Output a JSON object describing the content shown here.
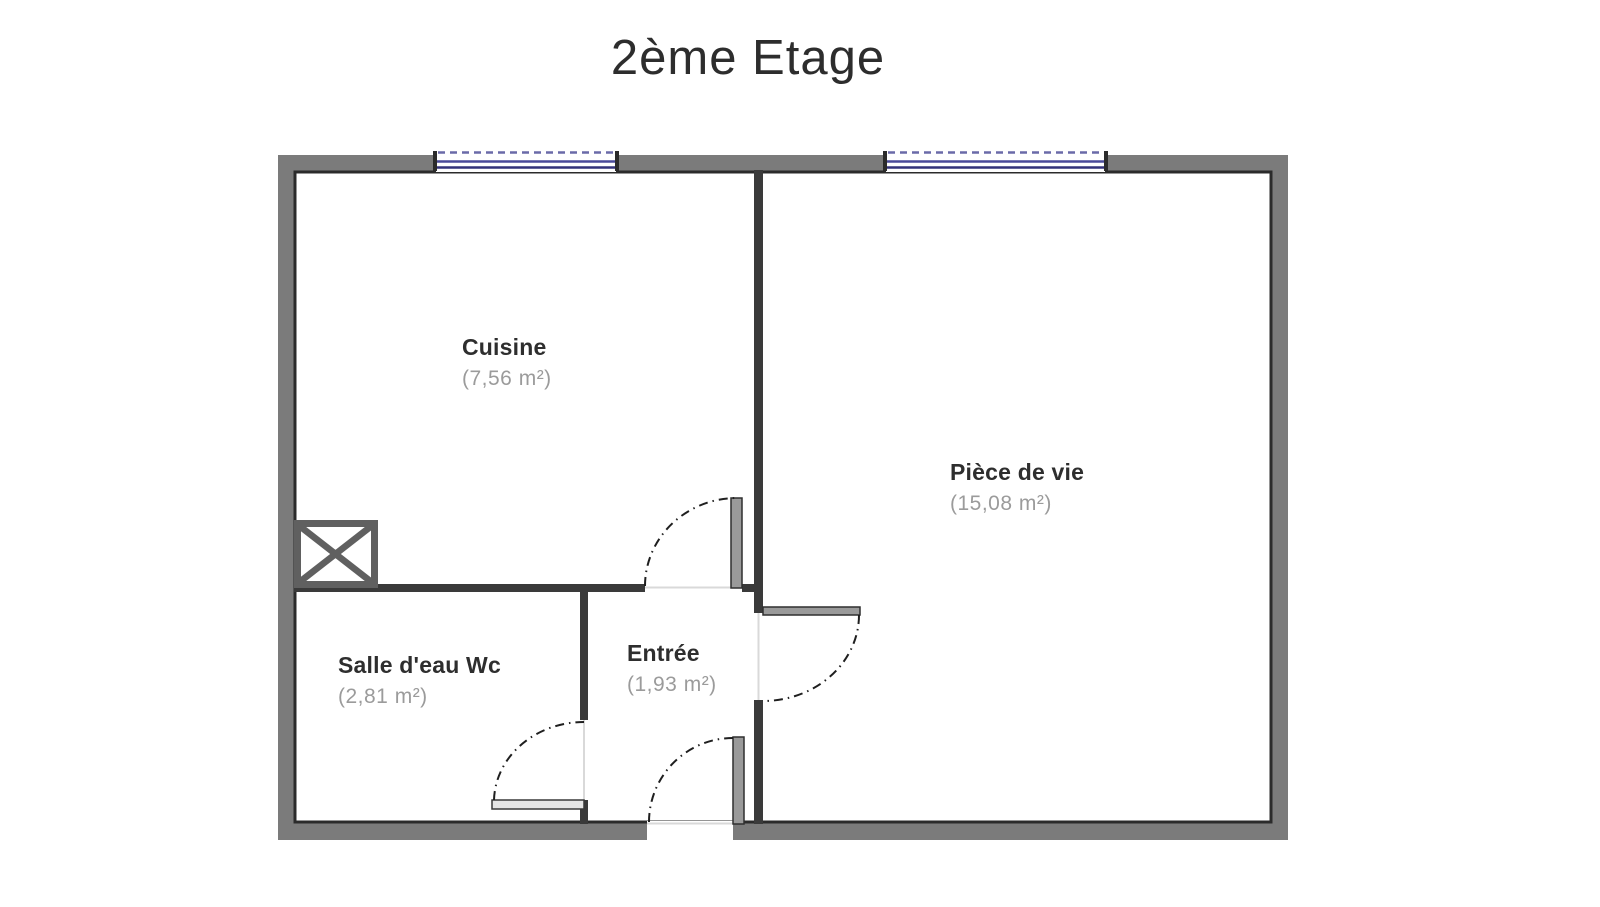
{
  "title": "2ème Etage",
  "plan": {
    "rooms": [
      {
        "id": "cuisine",
        "name": "Cuisine",
        "area": "(7,56 m²)"
      },
      {
        "id": "piece-de-vie",
        "name": "Pièce de vie",
        "area": "(15,08 m²)"
      },
      {
        "id": "salle-deau",
        "name": "Salle d'eau Wc",
        "area": "(2,81 m²)"
      },
      {
        "id": "entree",
        "name": "Entrée",
        "area": "(1,93 m²)"
      }
    ],
    "symbols": [
      "window-symbol",
      "door-swing-arc",
      "door-leaf",
      "shaft-symbol"
    ],
    "colors": {
      "exterior_wall": "#7b7b7b",
      "wall_inner_edge": "#2b2b2b",
      "interior_wall": "#3a3a3a",
      "window_accent": "#3e3e8e",
      "room_name_text": "#2e2e2e",
      "room_area_text": "#9b9b9b"
    }
  }
}
